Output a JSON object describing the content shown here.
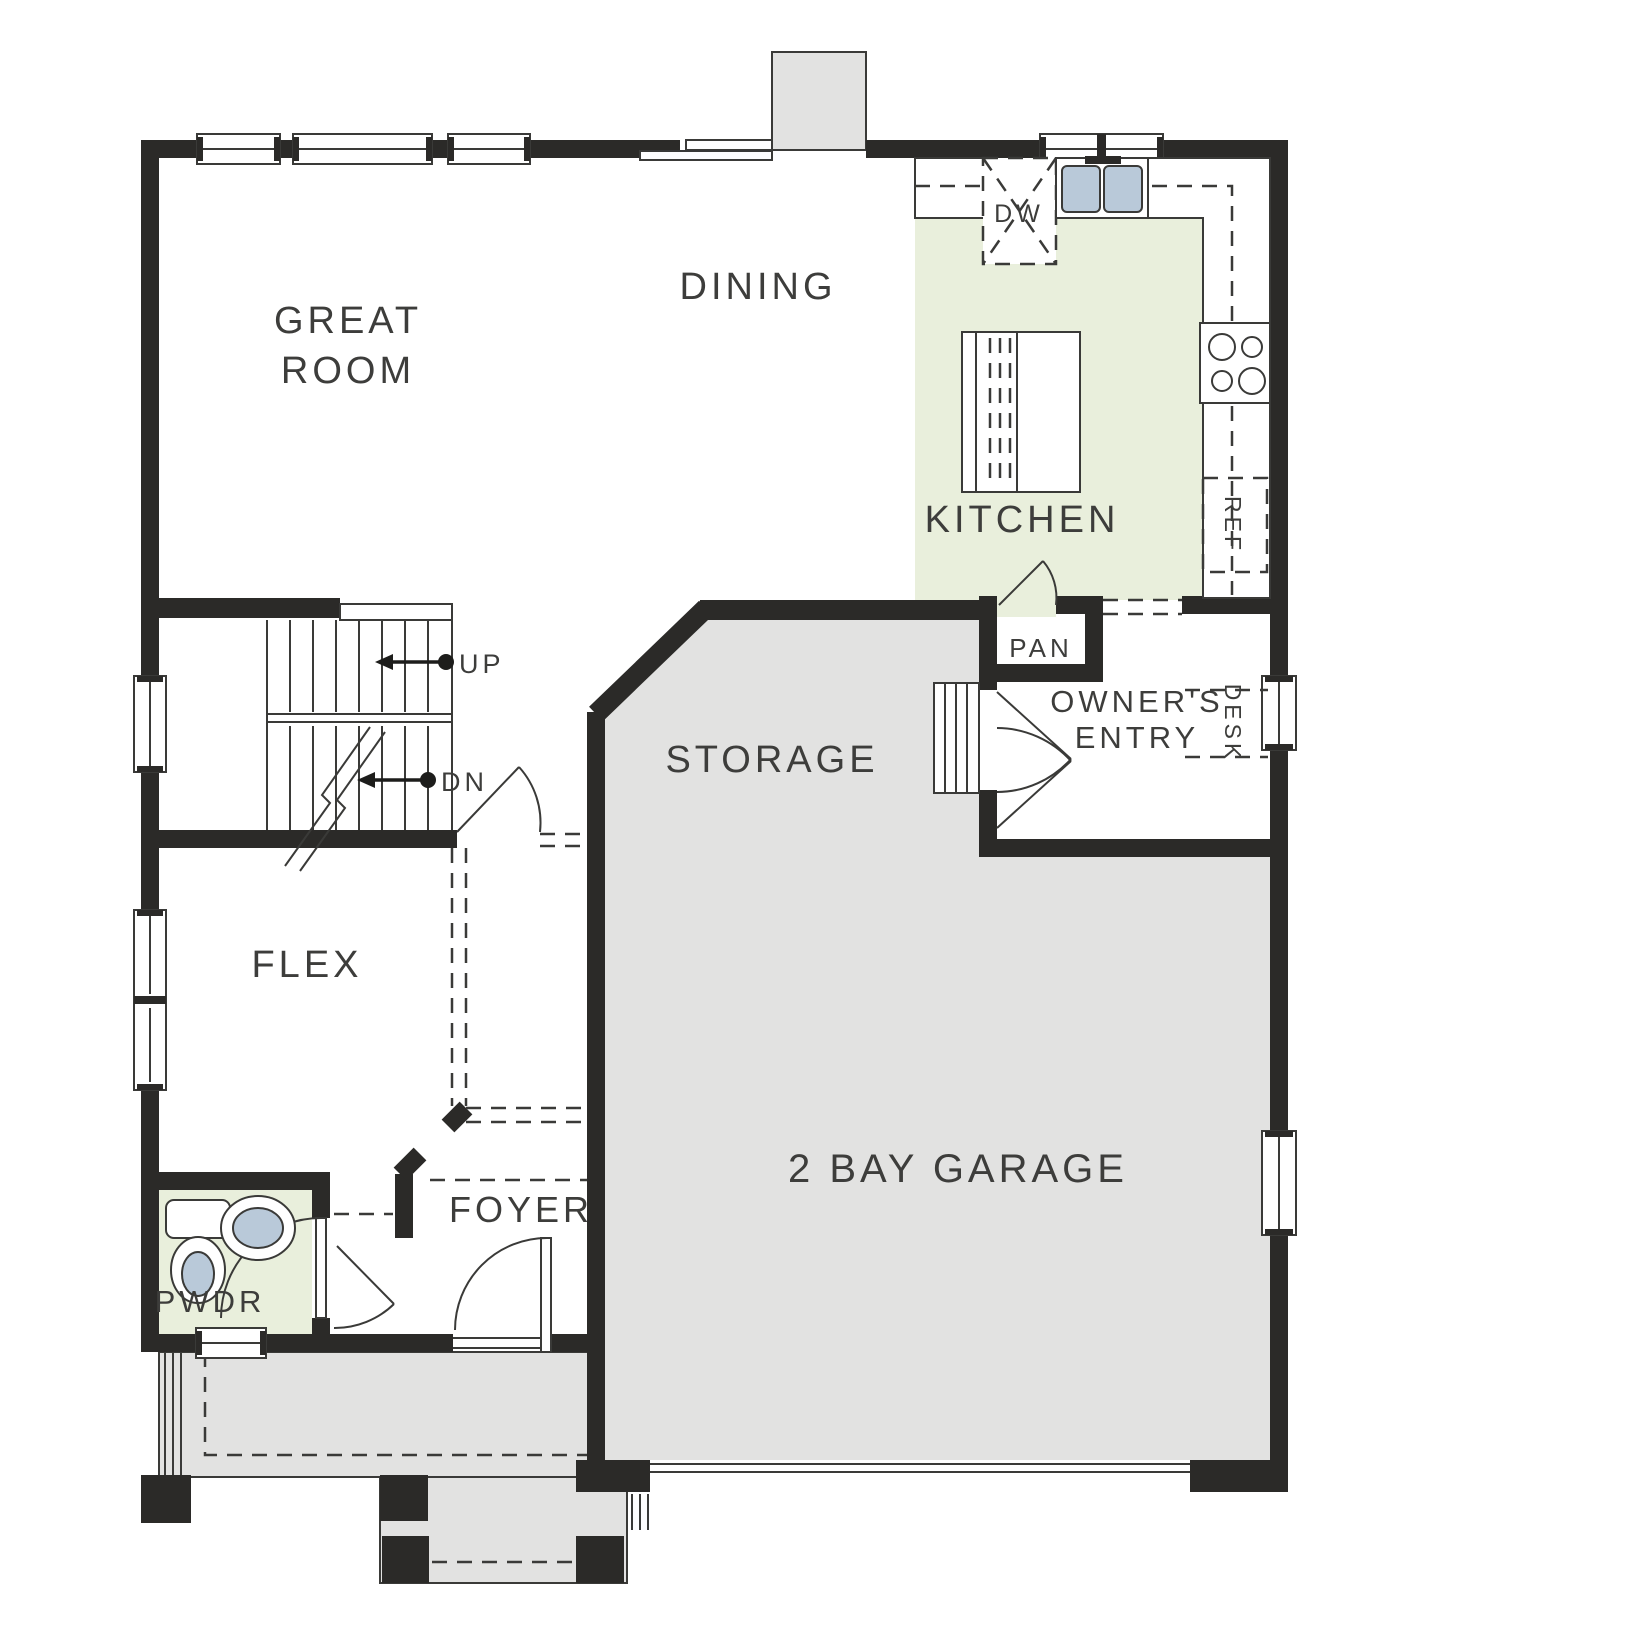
{
  "plan": {
    "type": "residential-first-floor-plan",
    "colors": {
      "wall": "#2b2a28",
      "floor_gray": "#e2e2e1",
      "floor_green": "#e9efdc",
      "fixture_blue": "#b9c9d9",
      "label": "#3d3d3b",
      "paper": "#ffffff"
    },
    "labels": {
      "great_line1": "GREAT",
      "great_line2": "ROOM",
      "dining": "DINING",
      "kitchen": "KITCHEN",
      "storage": "STORAGE",
      "owners_line1": "OWNER'S",
      "owners_line2": "ENTRY",
      "flex": "FLEX",
      "foyer": "FOYER",
      "pwdr": "PWDR",
      "garage": "2 BAY GARAGE",
      "pan": "PAN",
      "desk": "DESK",
      "ref": "REF",
      "dw": "DW",
      "up": "UP",
      "dn": "DN"
    }
  }
}
